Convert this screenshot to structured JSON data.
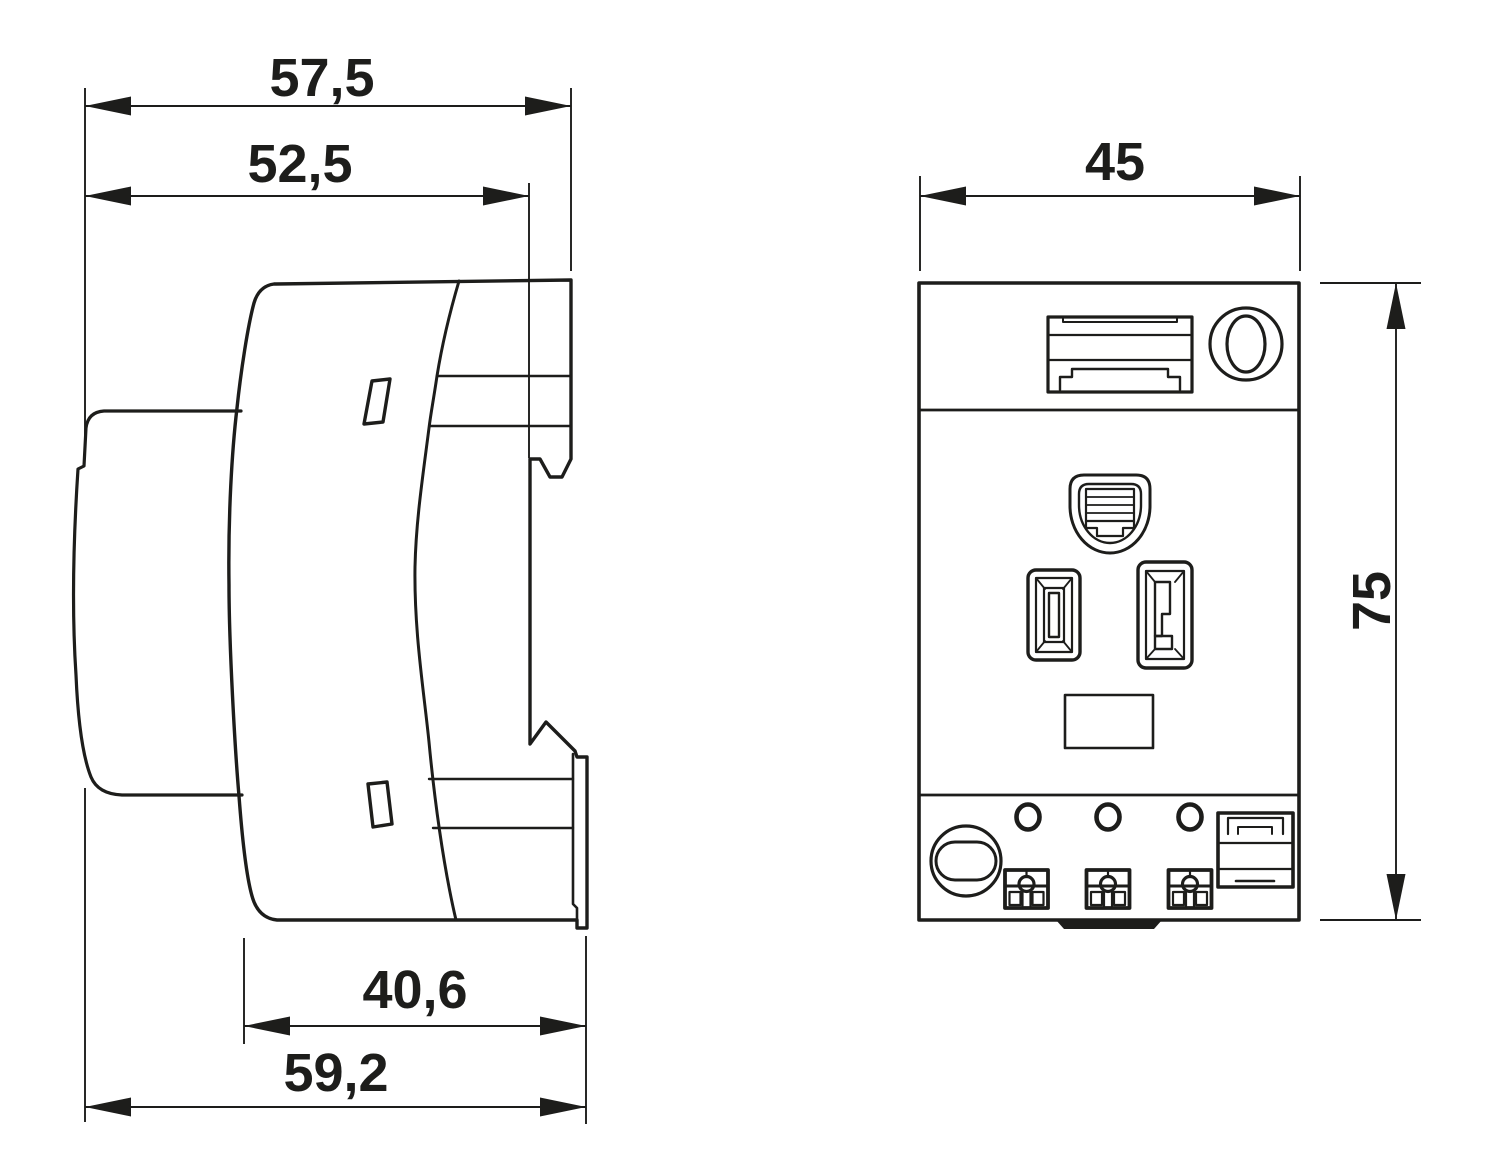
{
  "drawing": {
    "unit_system": "millimetres",
    "line_color": "#1d1d1b",
    "background": "#ffffff",
    "side_view": {
      "dims": [
        {
          "label": "57,5",
          "value": 57.5,
          "axis": "horizontal",
          "measures": "overall depth incl. top front edge"
        },
        {
          "label": "52,5",
          "value": 52.5,
          "axis": "horizontal",
          "measures": "depth to mid front face"
        },
        {
          "label": "40,6",
          "value": 40.6,
          "axis": "horizontal",
          "measures": "lower housing depth"
        },
        {
          "label": "59,2",
          "value": 59.2,
          "axis": "horizontal",
          "measures": "overall depth incl. foot"
        }
      ]
    },
    "front_view": {
      "dims": [
        {
          "label": "45",
          "value": 45,
          "axis": "horizontal",
          "measures": "overall width"
        },
        {
          "label": "75",
          "value": 75,
          "axis": "vertical",
          "measures": "overall height"
        }
      ]
    }
  }
}
